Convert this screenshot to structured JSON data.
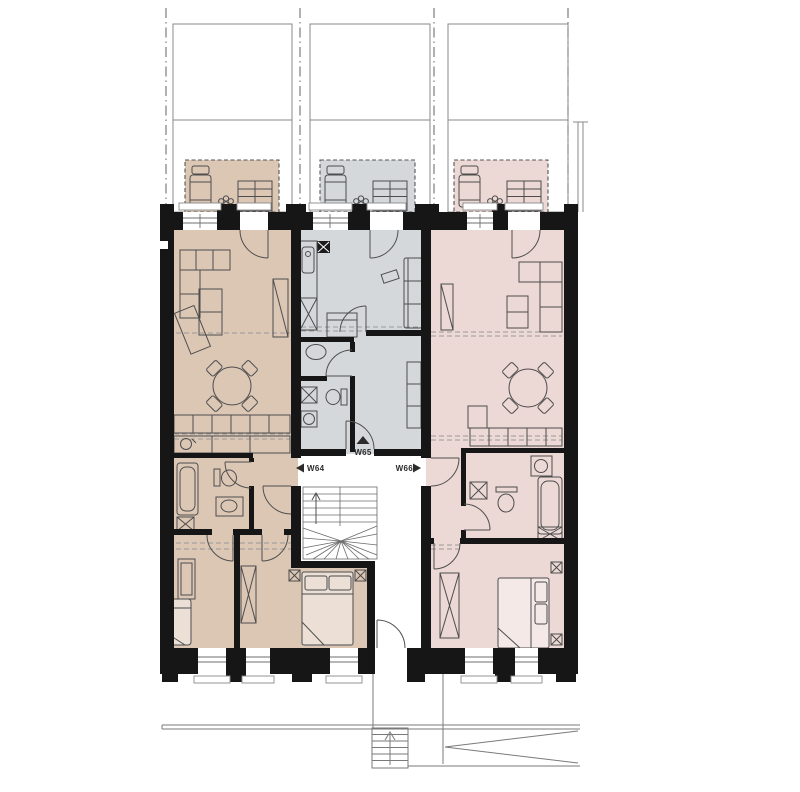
{
  "plan": {
    "type": "architectural-floor-plan",
    "description": "Residential floor plan with three apartments around a central winder stair, gardens with terraces at top, street entrance with exterior steps and ramp at bottom",
    "units": [
      {
        "id": "w64",
        "label": "W64",
        "color": "#dcc7b5",
        "position": "left",
        "entrance_arrow": "left"
      },
      {
        "id": "w65",
        "label": "W65",
        "color": "#d5d8db",
        "position": "middle",
        "entrance_arrow": "up"
      },
      {
        "id": "w66",
        "label": "W66",
        "color": "#ecd8d4",
        "position": "right",
        "entrance_arrow": "right"
      }
    ],
    "colors": {
      "wall": "#161616",
      "line": "#4f4f4f",
      "dashed_line": "#9a9a9a",
      "background": "#ffffff"
    },
    "terrace_items": [
      "sun-lounger-icon",
      "plant-icon",
      "garden-steps-icon"
    ],
    "fixture_icons": [
      "bathtub-icon",
      "toilet-icon",
      "sink-icon",
      "washer-icon",
      "stove-icon",
      "sofa-icon",
      "dining-table-icon",
      "bed-icon",
      "wardrobe-icon",
      "stair-icon"
    ]
  }
}
